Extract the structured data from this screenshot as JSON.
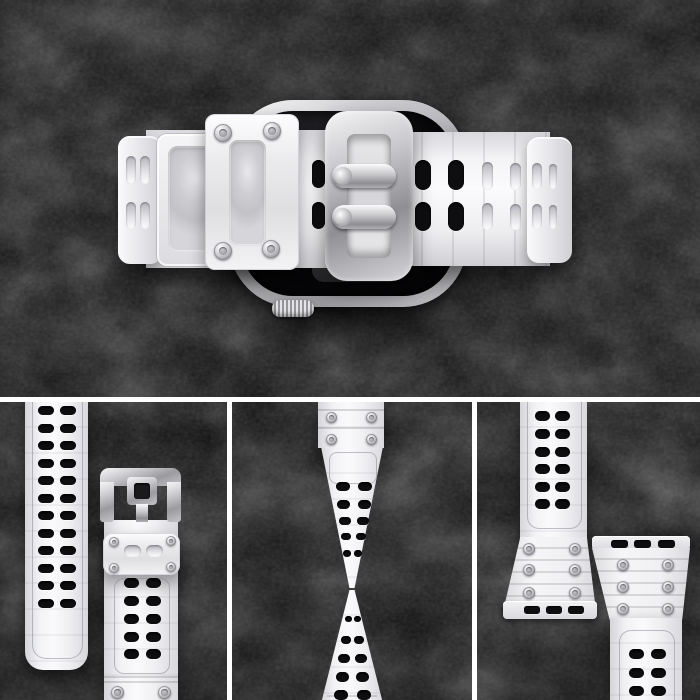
{
  "scene": {
    "type": "product-photo-collage",
    "subject": "white translucent rugged smartwatch band with silver buckle mounted on a silver smartwatch",
    "background": "dark slate stone texture",
    "views": {
      "main": "top view of watch with closed buckle, keeper loop and perforated straps",
      "panel_1": "front view of both straps: perforated tail strap and buckle strap with keeper",
      "panel_2": "twisted strap showing flexibility, hourglass shape",
      "panel_3": "two lug ends with connector slot bars, screws and ridged flares"
    },
    "text_content": "none"
  },
  "colors": {
    "background": "#101010",
    "texture_highlight": "#3c3c3c",
    "divider": "#ffffff",
    "band_white": "#f4f4f6",
    "band_mid": "#e3e3e7",
    "band_shadow": "#c7c7cc",
    "frost": "#cfcfd4",
    "silver_light": "#f2f2f4",
    "silver_mid": "#b7b7bb",
    "silver_dark": "#87878b",
    "hole_dark": "#0e0e10",
    "screen_black": "#050507"
  },
  "groups": {
    "hero_left_cap_slots": {
      "class": "hole-light",
      "name": "frost-slot",
      "items": [
        [
          126,
          156,
          10,
          28
        ],
        [
          140,
          156,
          10,
          28
        ],
        [
          126,
          202,
          10,
          27
        ],
        [
          140,
          202,
          10,
          27
        ]
      ]
    },
    "hero_keeper_screws": {
      "class": "screw",
      "name": "screw",
      "items": [
        [
          214,
          124,
          18,
          18
        ],
        [
          263,
          122,
          18,
          18
        ],
        [
          214,
          242,
          18,
          18
        ],
        [
          262,
          240,
          18,
          18
        ]
      ]
    },
    "hero_prong_holes": {
      "class": "hole-dark",
      "name": "strap-hole",
      "items": [
        [
          312,
          160,
          13,
          28
        ],
        [
          312,
          202,
          13,
          27
        ]
      ]
    },
    "hero_right_holes": {
      "class": "hole-dark",
      "name": "strap-hole",
      "items": [
        [
          415,
          160,
          16,
          30
        ],
        [
          448,
          160,
          16,
          30
        ],
        [
          415,
          202,
          16,
          29
        ],
        [
          448,
          202,
          16,
          29
        ]
      ]
    },
    "hero_right_slots": {
      "class": "hole-light",
      "name": "frost-slot",
      "items": [
        [
          482,
          162,
          11,
          28
        ],
        [
          510,
          163,
          11,
          27
        ],
        [
          532,
          163,
          10,
          26
        ],
        [
          549,
          164,
          8,
          25
        ],
        [
          482,
          203,
          11,
          27
        ],
        [
          510,
          204,
          11,
          26
        ],
        [
          532,
          204,
          10,
          25
        ],
        [
          549,
          205,
          8,
          24
        ]
      ]
    },
    "p1_left_holes": {
      "class": "hole-dark",
      "name": "strap-hole",
      "items": [
        [
          38,
          406,
          16,
          9
        ],
        [
          60,
          406,
          16,
          9
        ],
        [
          38,
          424,
          16,
          9
        ],
        [
          60,
          424,
          16,
          9
        ],
        [
          38,
          441,
          16,
          9
        ],
        [
          60,
          441,
          16,
          9
        ],
        [
          38,
          459,
          16,
          9
        ],
        [
          60,
          459,
          16,
          9
        ],
        [
          38,
          476,
          16,
          9
        ],
        [
          60,
          476,
          16,
          9
        ],
        [
          38,
          494,
          16,
          9
        ],
        [
          60,
          494,
          16,
          9
        ],
        [
          38,
          511,
          16,
          9
        ],
        [
          60,
          511,
          16,
          9
        ],
        [
          38,
          529,
          16,
          9
        ],
        [
          60,
          529,
          16,
          9
        ],
        [
          38,
          546,
          16,
          9
        ],
        [
          60,
          546,
          16,
          9
        ],
        [
          38,
          564,
          16,
          9
        ],
        [
          60,
          564,
          16,
          9
        ],
        [
          38,
          581,
          16,
          9
        ],
        [
          60,
          581,
          16,
          9
        ],
        [
          38,
          599,
          16,
          9
        ],
        [
          60,
          599,
          16,
          9
        ]
      ]
    },
    "p1_keeper_screws": {
      "class": "screw",
      "name": "screw",
      "items": [
        [
          109,
          537,
          10,
          10
        ],
        [
          166,
          536,
          10,
          10
        ],
        [
          109,
          563,
          10,
          10
        ],
        [
          166,
          562,
          10,
          10
        ]
      ]
    },
    "p1_keeper_slots": {
      "class": "hole-light",
      "name": "frost-slot",
      "items": [
        [
          124,
          545,
          17,
          12
        ],
        [
          146,
          545,
          17,
          12
        ]
      ]
    },
    "p1_strap_holes": {
      "class": "hole-dark",
      "name": "strap-hole",
      "items": [
        [
          124,
          578,
          15,
          10
        ],
        [
          146,
          578,
          15,
          10
        ],
        [
          124,
          596,
          15,
          10
        ],
        [
          146,
          596,
          15,
          10
        ],
        [
          124,
          614,
          15,
          10
        ],
        [
          146,
          614,
          15,
          10
        ],
        [
          124,
          632,
          15,
          10
        ],
        [
          146,
          632,
          15,
          10
        ],
        [
          124,
          649,
          15,
          10
        ],
        [
          146,
          649,
          15,
          10
        ]
      ]
    },
    "p1_bottom_screws": {
      "class": "screw",
      "name": "screw",
      "items": [
        [
          111,
          686,
          13,
          13
        ],
        [
          158,
          686,
          13,
          13
        ]
      ]
    },
    "p2_ridges": {
      "class": "ridge",
      "name": "connector-ridge",
      "items": [
        [
          318,
          409,
          66,
          2
        ],
        [
          318,
          427,
          66,
          2
        ]
      ]
    },
    "p2_connector_screws": {
      "class": "screw",
      "name": "screw",
      "items": [
        [
          326,
          412,
          11,
          11
        ],
        [
          366,
          412,
          11,
          11
        ],
        [
          326,
          434,
          11,
          11
        ],
        [
          366,
          434,
          11,
          11
        ]
      ]
    },
    "p2_top_holes": {
      "class": "hole-dark",
      "name": "strap-hole",
      "items": [
        [
          336,
          482,
          14,
          9
        ],
        [
          358,
          482,
          14,
          9
        ],
        [
          337,
          500,
          13,
          9
        ],
        [
          358,
          500,
          13,
          9
        ],
        [
          339,
          517,
          12,
          8
        ],
        [
          357,
          517,
          12,
          8
        ],
        [
          341,
          533,
          10,
          7
        ],
        [
          356,
          533,
          10,
          7
        ],
        [
          343,
          550,
          8,
          7
        ],
        [
          354,
          550,
          8,
          7
        ]
      ]
    },
    "p2_bottom_holes": {
      "class": "hole-dark",
      "name": "strap-hole",
      "items": [
        [
          345,
          616,
          7,
          6
        ],
        [
          354,
          616,
          7,
          6
        ],
        [
          341,
          636,
          10,
          8
        ],
        [
          354,
          636,
          10,
          8
        ],
        [
          338,
          654,
          12,
          9
        ],
        [
          355,
          654,
          12,
          9
        ],
        [
          336,
          672,
          13,
          10
        ],
        [
          356,
          672,
          13,
          10
        ],
        [
          334,
          690,
          14,
          10
        ],
        [
          357,
          690,
          14,
          10
        ]
      ]
    },
    "p3_left_holes": {
      "class": "hole-dark",
      "name": "strap-hole",
      "items": [
        [
          535,
          411,
          15,
          10
        ],
        [
          555,
          411,
          15,
          10
        ],
        [
          535,
          429,
          15,
          10
        ],
        [
          555,
          429,
          15,
          10
        ],
        [
          535,
          447,
          15,
          10
        ],
        [
          555,
          447,
          15,
          10
        ],
        [
          535,
          464,
          15,
          10
        ],
        [
          555,
          464,
          15,
          10
        ],
        [
          535,
          482,
          15,
          10
        ],
        [
          555,
          482,
          15,
          10
        ],
        [
          535,
          499,
          15,
          10
        ],
        [
          555,
          499,
          15,
          10
        ]
      ]
    },
    "p3_left_screws": {
      "class": "screw",
      "name": "screw",
      "items": [
        [
          523,
          543,
          12,
          12
        ],
        [
          569,
          543,
          12,
          12
        ],
        [
          523,
          564,
          12,
          12
        ],
        [
          569,
          564,
          12,
          12
        ],
        [
          523,
          587,
          12,
          12
        ],
        [
          569,
          587,
          12,
          12
        ]
      ]
    },
    "p3_left_slots": {
      "class": "slot-dark",
      "name": "connector-slot",
      "items": [
        [
          524,
          606,
          16,
          8
        ],
        [
          546,
          606,
          16,
          8
        ],
        [
          568,
          606,
          16,
          8
        ]
      ]
    },
    "p3_right_slots": {
      "class": "slot-dark",
      "name": "connector-slot",
      "items": [
        [
          611,
          540,
          17,
          8
        ],
        [
          634,
          540,
          17,
          8
        ],
        [
          658,
          540,
          17,
          8
        ]
      ]
    },
    "p3_right_screws": {
      "class": "screw",
      "name": "screw",
      "items": [
        [
          617,
          559,
          12,
          12
        ],
        [
          662,
          559,
          12,
          12
        ],
        [
          617,
          581,
          12,
          12
        ],
        [
          662,
          581,
          12,
          12
        ],
        [
          617,
          603,
          12,
          12
        ],
        [
          662,
          603,
          12,
          12
        ]
      ]
    },
    "p3_right_holes": {
      "class": "hole-dark",
      "name": "strap-hole",
      "items": [
        [
          629,
          649,
          15,
          10
        ],
        [
          651,
          649,
          15,
          10
        ],
        [
          629,
          668,
          15,
          10
        ],
        [
          651,
          668,
          15,
          10
        ],
        [
          629,
          686,
          15,
          10
        ],
        [
          651,
          686,
          15,
          10
        ]
      ]
    }
  }
}
